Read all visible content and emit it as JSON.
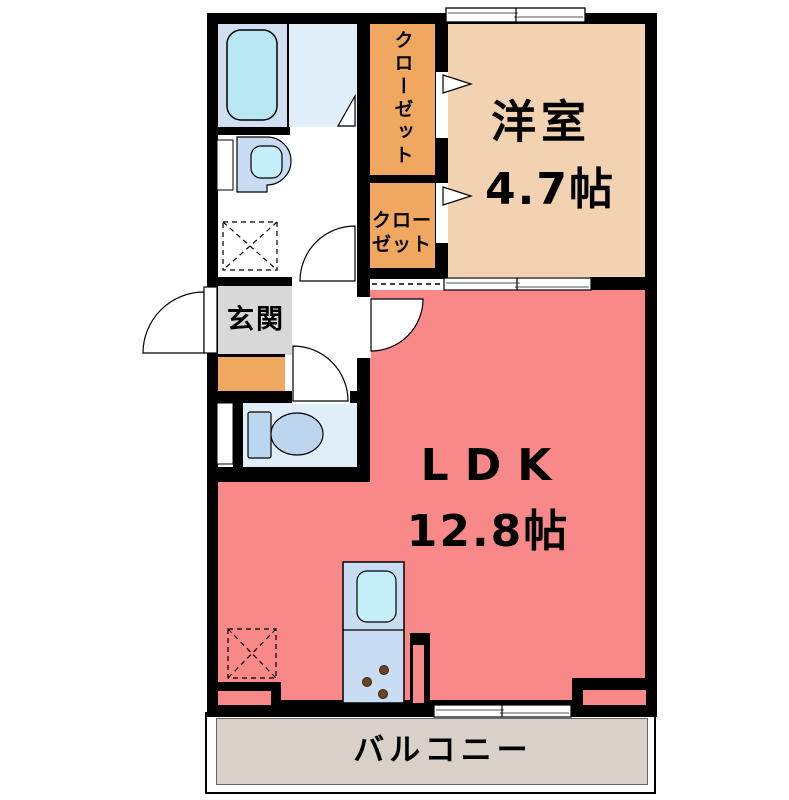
{
  "plan": {
    "type": "apartment-floor-plan",
    "rooms": {
      "western_room": {
        "label": "洋室",
        "size": "4.7帖"
      },
      "ldk": {
        "label": "LDK",
        "size": "12.8帖"
      },
      "genkan": {
        "label": "玄関"
      },
      "closet_upper": {
        "label": "クローゼット"
      },
      "closet_lower": {
        "line1": "クロー",
        "line2": "ゼット"
      },
      "balcony": {
        "label": "バルコニー"
      }
    },
    "fixtures": {
      "bathtub": "bathtub",
      "washbasin": "washbasin",
      "toilet": "toilet",
      "kitchen": "kitchen counter with sink and 3-burner stove",
      "washing_machine_space": "washing machine space (dashed square)",
      "refrigerator_space": "refrigerator space (dashed square)"
    },
    "colors": {
      "ldk_floor": "#f98888",
      "western_room_floor": "#f2d2b0",
      "closet_floor": "#f0a75f",
      "genkan_floor": "#d8d8d8",
      "genkan_step": "#f0a75f",
      "balcony_floor": "#d9d0c8",
      "bathroom_floor": "#e0eefa",
      "tub_area_floor": "#d0e0f2",
      "toilet_floor": "#e0eefa",
      "fixture_blue": "#c8ddf3",
      "fixture_cyan": "#c4eef8",
      "wall": "#000000"
    }
  }
}
